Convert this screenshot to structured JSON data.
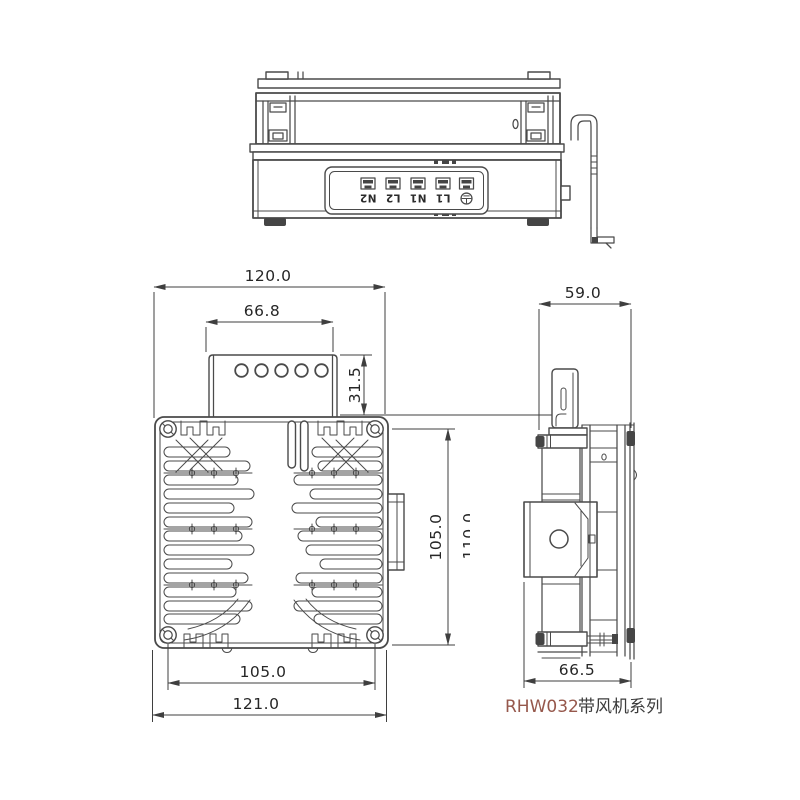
{
  "page": {
    "background": "#ffffff"
  },
  "colors": {
    "line": "#4a4a4a",
    "dim_line": "#3f3f3f",
    "dim_text": "#262626"
  },
  "caption": {
    "model": "RHW032",
    "series": "带风机系列",
    "model_color": "#96584c",
    "series_color": "#3c3c3c"
  },
  "top_view": {
    "terminals": {
      "labels": [
        "N2",
        "L2",
        "N1",
        "L1"
      ],
      "earth_icon": "earth-ground-icon"
    }
  },
  "front_view": {
    "dims": {
      "overall_width_top": "120.0",
      "terminal_box_width": "66.8",
      "terminal_box_height": "31.5",
      "mounting_height": "105.0",
      "overall_height_clipped": "110.0",
      "mounting_width": "105.0",
      "overall_width_bottom": "121.0"
    }
  },
  "side_view": {
    "dims": {
      "depth_top": "59.0",
      "depth_overall": "66.5"
    }
  }
}
